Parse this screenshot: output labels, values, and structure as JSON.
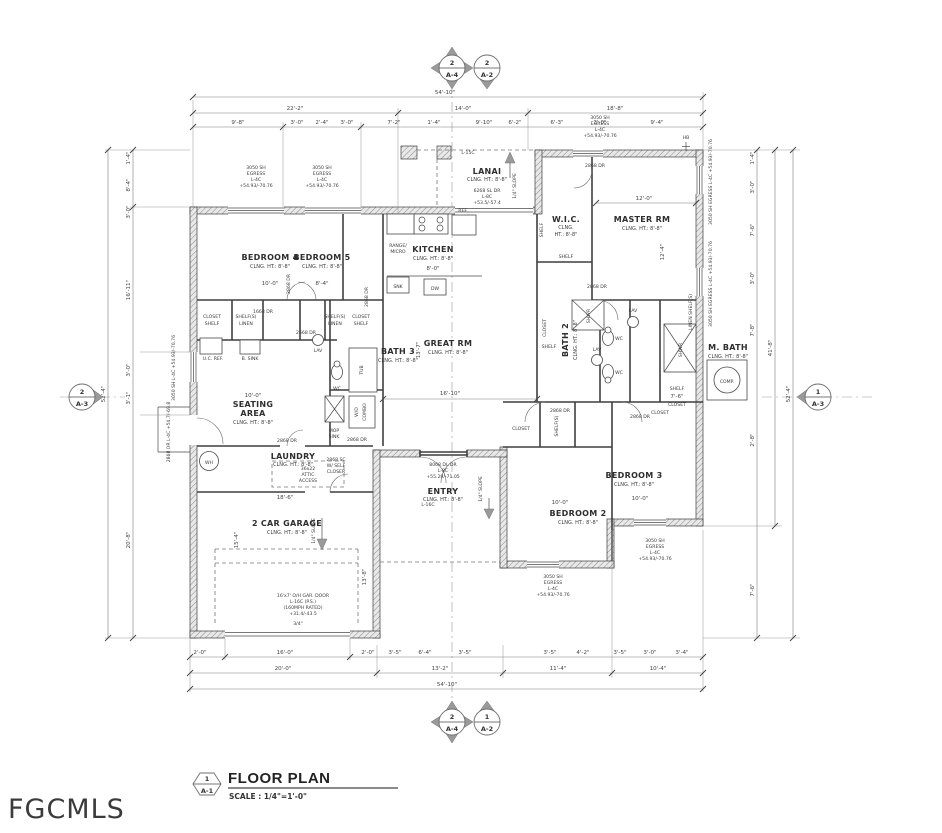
{
  "watermark": "FGCMLS",
  "title_block": {
    "detail_num": "1",
    "sheet": "A-1",
    "title": "FLOOR PLAN",
    "scale": "SCALE : 1/4\"=1'-0\""
  },
  "markers": {
    "top_a4": {
      "num": "2",
      "sheet": "A-4"
    },
    "top_a2": {
      "num": "2",
      "sheet": "A-2"
    },
    "bottom_a4": {
      "num": "2",
      "sheet": "A-4"
    },
    "bottom_a2": {
      "num": "1",
      "sheet": "A-2"
    },
    "left_a3": {
      "num": "2",
      "sheet": "A-3"
    },
    "right_a3": {
      "num": "1",
      "sheet": "A-3"
    }
  },
  "rooms": {
    "bedroom4": {
      "name": "BEDROOM 4",
      "ht": "CLNG. HT.: 8'-8\""
    },
    "bedroom5": {
      "name": "BEDROOM 5",
      "ht": "CLNG. HT.: 8'-8\""
    },
    "kitchen": {
      "name": "KITCHEN",
      "ht": "CLNG. HT.: 8'-8\""
    },
    "lanai": {
      "name": "LANAI",
      "ht": "CLNG. HT.: 8'-8\"",
      "door1": "6268 SL DR",
      "door2": "L-8C",
      "door3": "+53.5/-57.4"
    },
    "wic": {
      "name": "W.I.C.",
      "ht1": "CLNG.",
      "ht2": "HT.: 8'-8\""
    },
    "master": {
      "name": "MASTER RM",
      "ht": "CLNG. HT.: 8'-8\""
    },
    "bath3": {
      "name": "BATH 3",
      "ht": "CLNG. HT.: 8'-8\""
    },
    "great": {
      "name": "GREAT RM",
      "ht": "CLNG. HT.: 8'-8\""
    },
    "bath2": {
      "name": "BATH 2",
      "ht": "CLNG. HT.: 8'-8\""
    },
    "mbath": {
      "name": "M. BATH",
      "ht": "CLNG. HT.: 8'-8\""
    },
    "seating": {
      "name1": "SEATING",
      "name2": "AREA",
      "ht": "CLNG. HT.: 8'-8\""
    },
    "laundry": {
      "name": "LAUNDRY",
      "ht": "CLNG. HT.: 8'-8\""
    },
    "entry": {
      "name": "ENTRY",
      "ht": "CLNG. HT.: 8'-8\""
    },
    "bedroom2": {
      "name": "BEDROOM 2",
      "ht": "CLNG. HT.: 8'-8\""
    },
    "bedroom3": {
      "name": "BEDROOM 3",
      "ht": "CLNG. HT.: 8'-8\""
    },
    "garage": {
      "name": "2 CAR GARAGE",
      "ht": "CLNG. HT.: 8'-8\""
    }
  },
  "fixtures": {
    "ref": "REF.",
    "range": [
      "RANGE/",
      "MICRO"
    ],
    "snk": "SNK",
    "dw": "DW",
    "tub": "TUB",
    "wc": "WC",
    "lav": "LAV",
    "shwr": "SHWR",
    "wd": [
      "W/D",
      "COMBO"
    ],
    "mop": [
      "MOP",
      "SINK"
    ],
    "ucref": "U.C. REF.",
    "bsink": "B. SINK",
    "wh": "WH",
    "comp": "COMP.",
    "attic": [
      "36x22",
      "ATTIC",
      "ACCESS"
    ],
    "closet": "CLOSET",
    "shelf": "SHELF",
    "shelfs": "SHELF(S)",
    "linen": "LINEN",
    "linen_shelfs": "LINEN SHELF(S)"
  },
  "notes": {
    "slope": "1/4\" SLOPE",
    "l15c": "L-15C",
    "l16c": "L-16C",
    "hb": "HB",
    "gar_door": [
      "16'x7' O/H GAR. DOOR",
      "L-16C (P.S.)",
      "(160MPH RATED)",
      "+31.4/-43.5"
    ],
    "gar_slab": "3/4\"",
    "entry_door": [
      "8068 DL DR",
      "L-8C",
      "+55.29/-71.05"
    ],
    "self_close": [
      "2868 SC",
      "W/ SELF",
      "CLOSER"
    ],
    "dr2868": "2868 DR",
    "dr2668": "2668 DR",
    "dr1668": "1668 DR",
    "win_egress": [
      "3050 SH",
      "EGRESS",
      "L-4C",
      "+54.93/-70.76"
    ],
    "win_egress_full": "3050 SH EGRESS L-4C +54.93/-70.76",
    "win_left_full": "3050 SH L-4C +54.93/-70.76",
    "front_door_full": "2868 DR L-4C +54.7/-69.8"
  },
  "dims": {
    "top": {
      "overall": "54'-10\"",
      "t2": [
        "22'-2\"",
        "14'-0\"",
        "18'-8\""
      ],
      "t3": [
        "9'-8\"",
        "3'-0\"",
        "2'-4\"",
        "3'-0\"",
        "7'-2\"",
        "1'-4\"",
        "9'-10\"",
        "6'-2\"",
        "6'-3\"",
        "3'-0\"",
        "9'-4\""
      ]
    },
    "bottom": {
      "overall": "54'-10\"",
      "t2": [
        "20'-0\"",
        "13'-2\"",
        "11'-4\"",
        "10'-4\""
      ],
      "t3": [
        "2'-0\"",
        "16'-0\"",
        "2'-0\"",
        "3'-5\"",
        "6'-4\"",
        "3'-5\"",
        "3'-5\"",
        "4'-2\"",
        "3'-5\"",
        "3'-0\"",
        "3'-4\""
      ]
    },
    "left": {
      "overall": "52'-4\"",
      "t2": [
        "1'-4\"",
        "8'-4\"",
        "3'-0\"",
        "16'-11\"",
        "3'-0\"",
        "3'-1\"",
        "20'-8\""
      ]
    },
    "right": {
      "overall": "52'-4\"",
      "sub": "41'-8\"",
      "t3": [
        "1'-4\"",
        "3'-0\"",
        "7'-6\"",
        "3'-0\"",
        "7'-8\"",
        "2'-8\"",
        "7'-6\""
      ]
    },
    "interior": [
      "10'-0\"",
      "8'-4\"",
      "8'-0\"",
      "12'-0\"",
      "12'-4\"",
      "16'-10\"",
      "13'-7\"",
      "10'-0\"",
      "10'-0\"",
      "10'-0\"",
      "18'-6\"",
      "13'-8\"",
      "15'-4\"",
      "7'-6\""
    ]
  }
}
